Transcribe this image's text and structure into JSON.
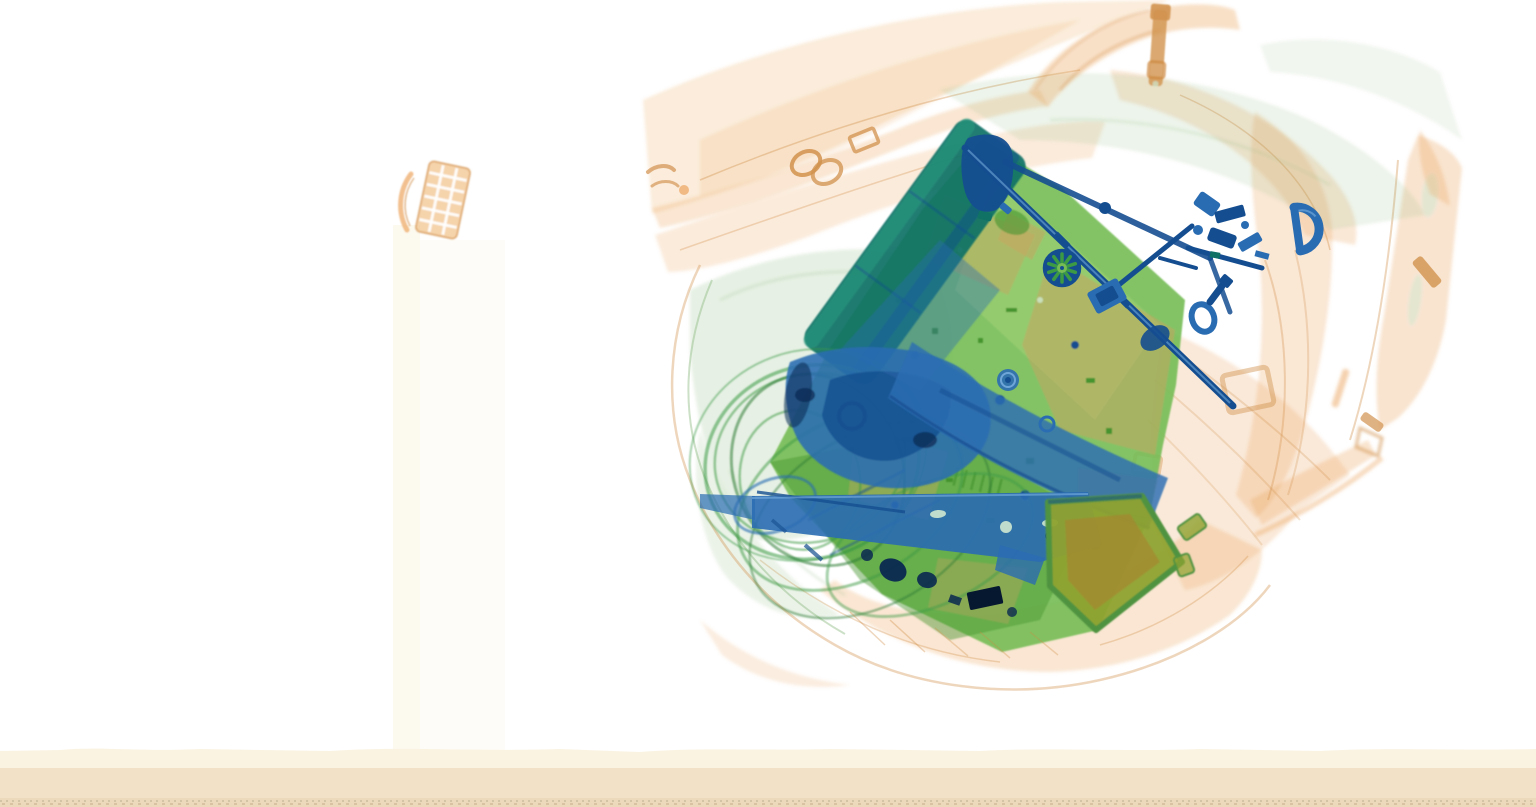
{
  "scene": {
    "type": "x-ray-baggage-scan",
    "description": "Airport security X-ray scan of a backpack on a conveyor belt containing a laptop motherboard with cooling fan and chips, a hard drive, metal bracket and rods, coiled cables, keys and tools, a D-ring and swivel clasp, and a dense olive-colored case; translucent orange straps, handle and zipper pulls surround the electronics",
    "background_color": "#ffffff"
  },
  "palette": {
    "background": "#ffffff",
    "fabric_orange": "#eca55f",
    "fabric_orange_light": "#f2c896",
    "fabric_orange_deep": "#cf8a42",
    "zipper_orange": "#d1924e",
    "fabric_green": "#8fba82",
    "cable_green": "#3c9a44",
    "cable_green_dark": "#2e7d36",
    "board_green": "#76bc55",
    "board_green_dark": "#44942f",
    "board_green_light": "#a9d478",
    "tan_patch": "#c9a45f",
    "metal_teal": "#0f7265",
    "metal_teal_light": "#2a9a80",
    "metal_blue": "#2a6cb2",
    "metal_blue_dark": "#154e90",
    "metal_blue_light": "#6fa6d8",
    "metal_navy": "#0a2850",
    "ink_black": "#061830",
    "olive_box": "#8ea22f",
    "olive_box_rim": "#4f9340",
    "olive_box_brown": "#a8842e",
    "hole_light": "#cfe8cf",
    "mesh_hole_white": "#ffffff",
    "belt_cream": "#faf3e2",
    "belt_beige": "#f3e1c7",
    "belt_beige_dark": "#ecd8ba",
    "belt_speckle_1": "#b9ab90",
    "belt_speckle_2": "#c3a887",
    "artifact_band": "#fbf7ea"
  },
  "material_legend": {
    "orange": "organic material (fabric, leather, paper)",
    "green": "mixed material (circuit boards, plastics)",
    "blue": "dense metal (steel, tools, drives)"
  },
  "objects": [
    {
      "id": "backpack-shell",
      "material": "organic",
      "color_ref": "fabric_orange"
    },
    {
      "id": "bag-handle",
      "material": "organic",
      "color_ref": "fabric_orange"
    },
    {
      "id": "zipper-pull",
      "material": "organic",
      "color_ref": "zipper_orange"
    },
    {
      "id": "shoulder-strap-right",
      "material": "organic",
      "color_ref": "fabric_orange"
    },
    {
      "id": "mesh-pouch-item",
      "material": "organic",
      "color_ref": "fabric_orange_light"
    },
    {
      "id": "motherboard",
      "material": "mixed",
      "color_ref": "board_green"
    },
    {
      "id": "battery-bar",
      "material": "mixed-metal",
      "color_ref": "metal_teal"
    },
    {
      "id": "cooling-fan-large",
      "material": "metal",
      "color_ref": "metal_blue"
    },
    {
      "id": "cooling-fan-small",
      "material": "metal",
      "color_ref": "metal_blue"
    },
    {
      "id": "cpu-chip",
      "material": "metal",
      "color_ref": "metal_blue_dark"
    },
    {
      "id": "hard-drive",
      "material": "metal",
      "color_ref": "metal_blue"
    },
    {
      "id": "mounting-bracket",
      "material": "metal",
      "color_ref": "metal_blue"
    },
    {
      "id": "metal-rod",
      "material": "metal",
      "color_ref": "metal_blue_dark"
    },
    {
      "id": "coiled-cables",
      "material": "mixed",
      "color_ref": "cable_green"
    },
    {
      "id": "keys-tools-cluster",
      "material": "metal",
      "color_ref": "metal_blue_dark"
    },
    {
      "id": "d-ring",
      "material": "metal",
      "color_ref": "metal_blue"
    },
    {
      "id": "swivel-clasp",
      "material": "metal",
      "color_ref": "metal_blue"
    },
    {
      "id": "olive-case",
      "material": "dense-organic",
      "color_ref": "olive_box"
    },
    {
      "id": "dark-components",
      "material": "very-dense",
      "color_ref": "ink_black"
    },
    {
      "id": "conveyor-belt",
      "material": "belt",
      "color_ref": "belt_beige"
    }
  ],
  "conveyor_belt": {
    "bands": [
      {
        "name": "cream-strip",
        "color_ref": "belt_cream"
      },
      {
        "name": "beige-band",
        "color_ref": "belt_beige"
      },
      {
        "name": "speckled-edge",
        "color_ref": "belt_beige_dark"
      }
    ]
  }
}
